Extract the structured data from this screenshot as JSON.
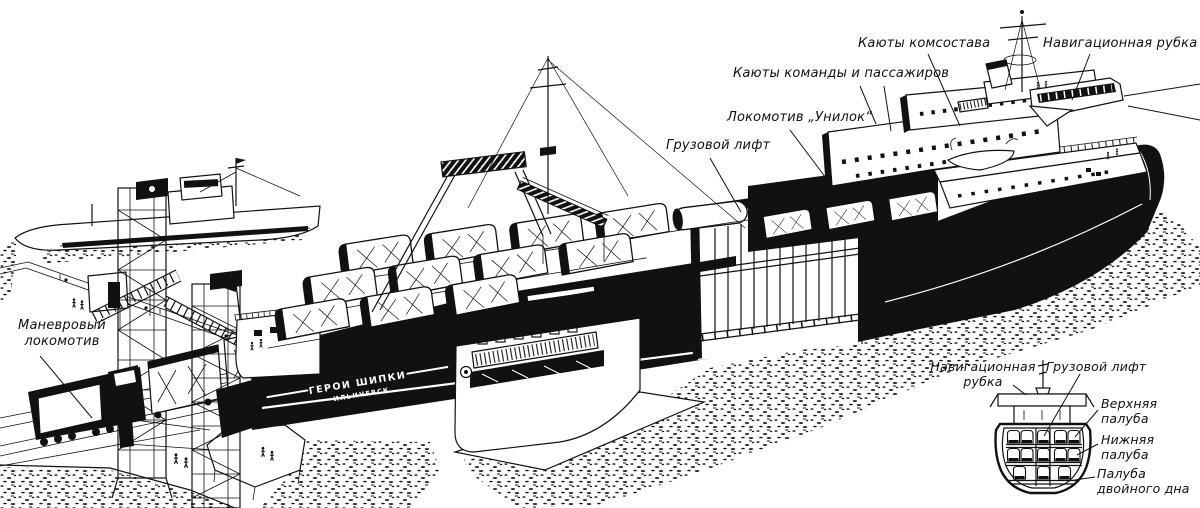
{
  "figure": {
    "subject": "Cutaway illustration of a railway ferry moored at a pier with gantry towers",
    "style": "black-and-white line engraving",
    "ink_color": "#111111",
    "paper_color": "#ffffff"
  },
  "callouts": {
    "officers_cabins": "Каюты комсостава",
    "navigation_bridge": "Навигационная рубка",
    "crew_passenger_cabins": "Каюты команды и пассажиров",
    "unilok_locomotive": "Локомотив „Унилок“",
    "cargo_lift": "Грузовой лифт",
    "shunting_locomotive": "Маневровый\nлокомотив"
  },
  "ship": {
    "name": "ГЕРОИ ШИПКИ",
    "home_port": "ИЛЬИЧЕВСК"
  },
  "inset": {
    "navigation_bridge": "Навигационная\nрубка",
    "cargo_lift": "Грузовой лифт",
    "upper_deck": "Верхняя\nпалуба",
    "lower_deck": "Нижняя\nпалуба",
    "double_bottom_deck": "Палуба\nдвойного дна"
  }
}
